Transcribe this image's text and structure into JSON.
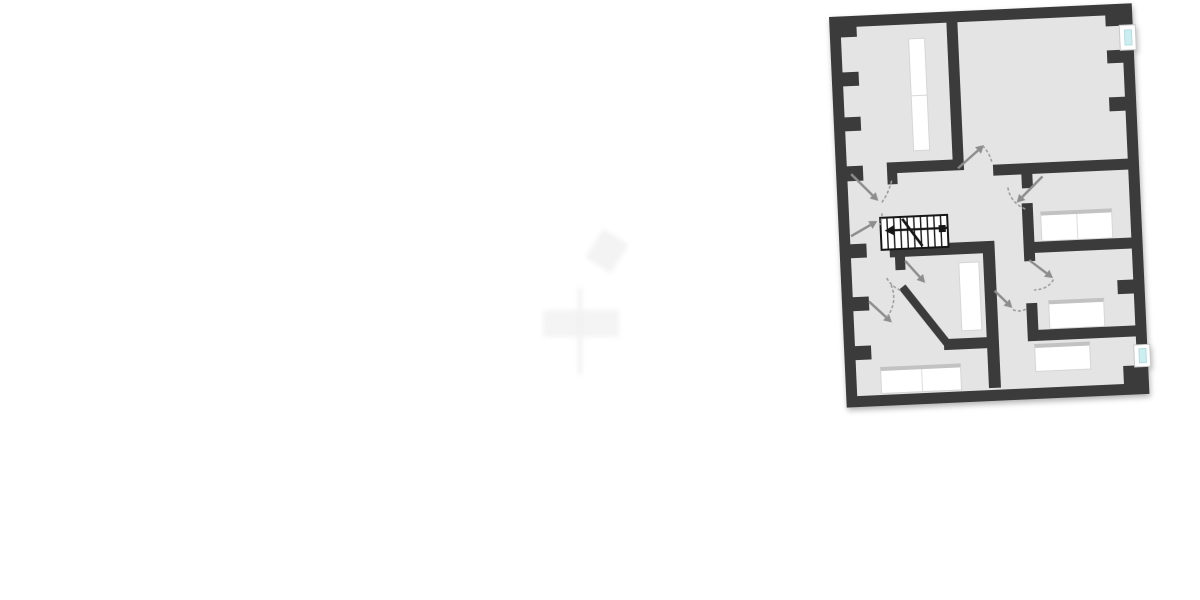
{
  "canvas": {
    "width": 1200,
    "height": 600,
    "background": "#ffffff"
  },
  "colors": {
    "wall": "#3b3b3b",
    "floor": "#e4e4e4",
    "stairs_line": "#161616",
    "door_arrow": "#8d8d8d",
    "door_arc": "#9e9e9e",
    "window_glass": "#cdeef0",
    "window_frame": "#ffffff",
    "furniture": "#ffffff",
    "headboard": "#c2c2c2",
    "watermark": "#f4f4f4"
  },
  "plan": {
    "left": 829,
    "top": 17,
    "width": 303,
    "height": 391,
    "rotation_deg": -2.6,
    "outer_wall_thickness": 11,
    "floor_rect": {
      "x": 6,
      "y": 6,
      "w": 291,
      "h": 379
    }
  },
  "outer_walls": [
    {
      "name": "outer-wall-top",
      "x": 0,
      "y": 0,
      "w": 303,
      "h": 11
    },
    {
      "name": "outer-wall-left",
      "x": 0,
      "y": 0,
      "w": 11,
      "h": 391
    },
    {
      "name": "outer-wall-bottom",
      "x": 0,
      "y": 380,
      "w": 303,
      "h": 11
    },
    {
      "name": "outer-wall-right-upper",
      "x": 292,
      "y": 0,
      "w": 11,
      "h": 22
    },
    {
      "name": "outer-wall-right-middle",
      "x": 292,
      "y": 47,
      "w": 11,
      "h": 294
    },
    {
      "name": "outer-wall-right-lower",
      "x": 292,
      "y": 364,
      "w": 11,
      "h": 27
    }
  ],
  "interior_walls": [
    {
      "name": "wall-topleft-room-right",
      "x": 117,
      "y": 11,
      "w": 11,
      "h": 142
    },
    {
      "name": "wall-topleft-room-bottom",
      "x": 51,
      "y": 148,
      "w": 77,
      "h": 11
    },
    {
      "name": "door-post-hall-a",
      "x": 51,
      "y": 159,
      "w": 10,
      "h": 11
    },
    {
      "name": "wall-topright-room-bottom",
      "x": 157,
      "y": 155,
      "w": 136,
      "h": 11
    },
    {
      "name": "door-post-room-a",
      "x": 185,
      "y": 166,
      "w": 11,
      "h": 14
    },
    {
      "name": "wall-room-a-left",
      "x": 184,
      "y": 195,
      "w": 11,
      "h": 58
    },
    {
      "name": "wall-room-ab-divider",
      "x": 190,
      "y": 234,
      "w": 103,
      "h": 11
    },
    {
      "name": "wall-hall-bottom",
      "x": 50,
      "y": 231,
      "w": 105,
      "h": 12
    },
    {
      "name": "door-post-hall-b",
      "x": 55,
      "y": 243,
      "w": 10,
      "h": 13
    },
    {
      "name": "wall-bottom-rooms-divider",
      "x": 143,
      "y": 243,
      "w": 12,
      "h": 135
    },
    {
      "name": "wall-bottomleft-room-top",
      "x": 100,
      "y": 327,
      "w": 43,
      "h": 11
    },
    {
      "name": "wall-room-b-left-lower",
      "x": 184,
      "y": 295,
      "w": 11,
      "h": 33
    },
    {
      "name": "wall-room-b-bottom",
      "x": 184,
      "y": 322,
      "w": 109,
      "h": 11
    }
  ],
  "diagonal_wall": {
    "name": "wall-bottomleft-room-diagonal",
    "x1": 61,
    "y1": 273,
    "x2": 103,
    "y2": 331,
    "thickness": 8
  },
  "wall_nubs": [
    {
      "name": "wall-nub",
      "x": 11,
      "y": 11,
      "w": 16,
      "h": 10
    },
    {
      "name": "wall-nub",
      "x": 11,
      "y": 56,
      "w": 16,
      "h": 14
    },
    {
      "name": "wall-nub",
      "x": 11,
      "y": 101,
      "w": 16,
      "h": 14
    },
    {
      "name": "wall-nub",
      "x": 11,
      "y": 150,
      "w": 16,
      "h": 15
    },
    {
      "name": "wall-nub",
      "x": 11,
      "y": 228,
      "w": 16,
      "h": 14
    },
    {
      "name": "wall-nub",
      "x": 11,
      "y": 281,
      "w": 16,
      "h": 14
    },
    {
      "name": "wall-nub",
      "x": 11,
      "y": 330,
      "w": 16,
      "h": 14
    },
    {
      "name": "wall-nub",
      "x": 276,
      "y": 11,
      "w": 16,
      "h": 11
    },
    {
      "name": "wall-nub",
      "x": 276,
      "y": 46,
      "w": 16,
      "h": 13
    },
    {
      "name": "wall-nub",
      "x": 276,
      "y": 93,
      "w": 16,
      "h": 14
    },
    {
      "name": "wall-nub",
      "x": 276,
      "y": 276,
      "w": 16,
      "h": 14
    },
    {
      "name": "wall-nub",
      "x": 278,
      "y": 362,
      "w": 14,
      "h": 19
    }
  ],
  "windows": [
    {
      "name": "window-right-top",
      "frame": {
        "x": 289,
        "y": 21,
        "w": 17,
        "h": 26
      },
      "glass": {
        "x": 294,
        "y": 26,
        "w": 8,
        "h": 16
      }
    },
    {
      "name": "window-right-bottom",
      "frame": {
        "x": 289,
        "y": 341,
        "w": 17,
        "h": 23
      },
      "glass": {
        "x": 294,
        "y": 345,
        "w": 8,
        "h": 15
      }
    }
  ],
  "rooms": [
    {
      "name": "room-top-left",
      "x": 11,
      "y": 11,
      "w": 106,
      "h": 137
    },
    {
      "name": "room-top-right",
      "x": 128,
      "y": 11,
      "w": 164,
      "h": 144
    },
    {
      "name": "hall-with-stairs",
      "x": 11,
      "y": 159,
      "w": 173,
      "h": 72
    },
    {
      "name": "room-right-upper",
      "x": 195,
      "y": 166,
      "w": 97,
      "h": 68
    },
    {
      "name": "room-right-middle",
      "x": 195,
      "y": 245,
      "w": 97,
      "h": 77
    },
    {
      "name": "room-bottom-left",
      "x": 11,
      "y": 272,
      "w": 132,
      "h": 108
    },
    {
      "name": "room-bottom-right",
      "x": 155,
      "y": 333,
      "w": 137,
      "h": 47
    },
    {
      "name": "room-center-small",
      "x": 65,
      "y": 243,
      "w": 78,
      "h": 84
    }
  ],
  "stairs": {
    "name": "staircase",
    "x": 42,
    "y": 203,
    "w": 67,
    "h": 32,
    "tread_count": 10,
    "diagonal": {
      "x1": 22,
      "y1": 2,
      "x2": 41,
      "y2": 30
    },
    "arrow_shaft_y": 13,
    "arrow_tip_x": 4,
    "arrow_tail_x": 62,
    "tail_block": {
      "x": 58,
      "y": 10,
      "w": 7,
      "h": 7
    }
  },
  "furniture": [
    {
      "name": "roof-window-top-left-room",
      "x": 78,
      "y": 25,
      "w": 17,
      "h": 113,
      "headboard": false,
      "divider": "h"
    },
    {
      "name": "roof-window-center-room",
      "x": 118,
      "y": 251,
      "w": 21,
      "h": 69,
      "headboard": false,
      "divider": ""
    },
    {
      "name": "double-bed-right-upper",
      "x": 202,
      "y": 204,
      "w": 72,
      "h": 30,
      "headboard": true,
      "divider": "v"
    },
    {
      "name": "bed-right-middle",
      "x": 206,
      "y": 293,
      "w": 56,
      "h": 29,
      "headboard": true,
      "divider": ""
    },
    {
      "name": "bed-bottom-right",
      "x": 190,
      "y": 336,
      "w": 56,
      "h": 28,
      "headboard": true,
      "divider": ""
    },
    {
      "name": "double-bed-bottom-left",
      "x": 35,
      "y": 352,
      "w": 81,
      "h": 27,
      "headboard": true,
      "divider": "v"
    }
  ],
  "door_arrows": [
    {
      "name": "door-swing-hall-upper-left",
      "x1": 15,
      "y1": 158,
      "x2": 41,
      "y2": 186
    },
    {
      "name": "door-swing-stairs-approach",
      "x1": 12,
      "y1": 220,
      "x2": 39,
      "y2": 206
    },
    {
      "name": "door-swing-center-room",
      "x1": 65,
      "y1": 247,
      "x2": 84,
      "y2": 270
    },
    {
      "name": "door-swing-bottom-left-room",
      "x1": 27,
      "y1": 286,
      "x2": 49,
      "y2": 308
    },
    {
      "name": "door-swing-top-right-room",
      "x1": 122,
      "y1": 157,
      "x2": 149,
      "y2": 135
    },
    {
      "name": "door-swing-right-upper-room",
      "x1": 206,
      "y1": 169,
      "x2": 179,
      "y2": 194
    },
    {
      "name": "door-swing-right-middle-room",
      "x1": 189,
      "y1": 252,
      "x2": 212,
      "y2": 271
    },
    {
      "name": "door-swing-corridor",
      "x1": 153,
      "y1": 281,
      "x2": 170,
      "y2": 299
    }
  ],
  "door_arcs": [
    {
      "x1": 55,
      "y1": 167,
      "cx": 50,
      "cy": 182,
      "x2": 43,
      "y2": 189
    },
    {
      "x1": 44,
      "y1": 199,
      "cx": 44,
      "cy": 205,
      "x2": 41,
      "y2": 210
    },
    {
      "x1": 46,
      "y1": 264,
      "cx": 52,
      "cy": 274,
      "x2": 61,
      "y2": 277
    },
    {
      "x1": 50,
      "y1": 271,
      "cx": 56,
      "cy": 288,
      "x2": 44,
      "y2": 303
    },
    {
      "x1": 148,
      "y1": 136,
      "cx": 154,
      "cy": 143,
      "x2": 156,
      "y2": 152
    },
    {
      "x1": 171,
      "y1": 179,
      "cx": 173,
      "cy": 194,
      "x2": 188,
      "y2": 201
    },
    {
      "x1": 212,
      "y1": 273,
      "cx": 206,
      "cy": 282,
      "x2": 193,
      "y2": 282
    },
    {
      "x1": 171,
      "y1": 301,
      "cx": 178,
      "cy": 304,
      "x2": 185,
      "y2": 300
    }
  ],
  "watermark_shapes": [
    {
      "name": "watermark-blob",
      "x": 592,
      "y": 234,
      "w": 30,
      "h": 34,
      "rotate": 32,
      "color": "#f3f3f3"
    },
    {
      "name": "watermark-bar",
      "x": 543,
      "y": 310,
      "w": 76,
      "h": 27,
      "rotate": 0,
      "color": "#f4f4f4"
    },
    {
      "name": "watermark-stem",
      "x": 578,
      "y": 288,
      "w": 4,
      "h": 86,
      "rotate": 0,
      "color": "#f1f1f1"
    }
  ]
}
